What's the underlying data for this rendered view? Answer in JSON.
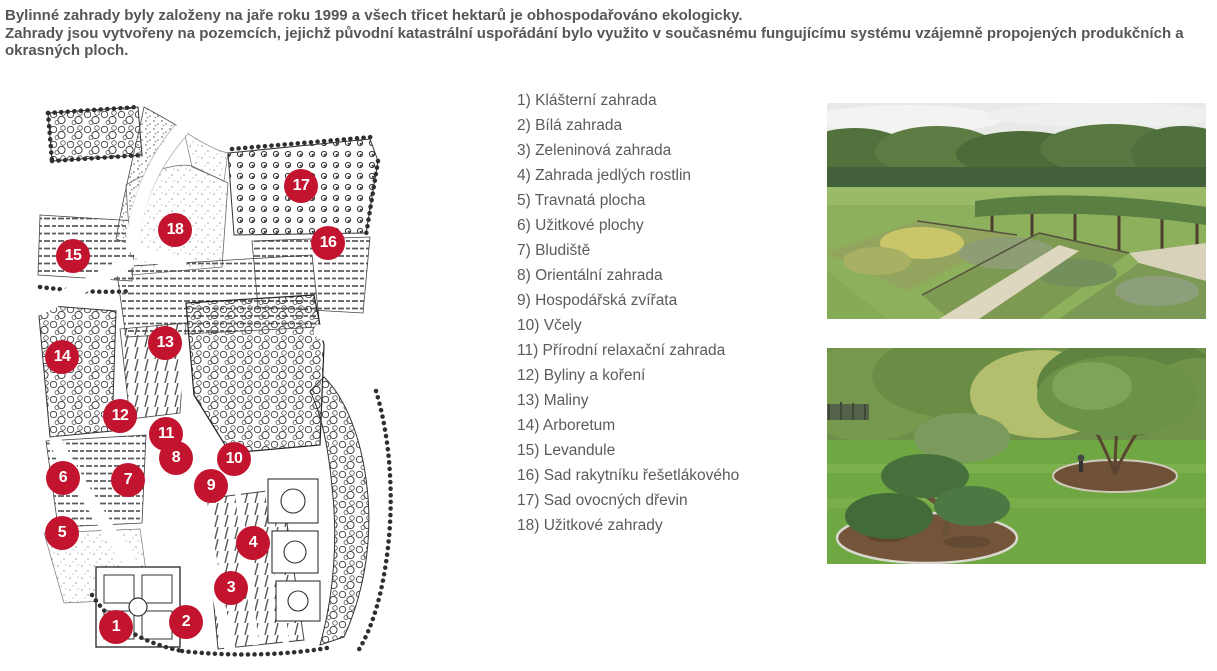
{
  "intro": {
    "p1": "Bylinné zahrady byly založeny na jaře roku 1999 a všech třicet hektarů je obhospodařováno ekologicky.",
    "p2": "Zahrady jsou vytvořeny na pozemcích, jejichž původní katastrální uspořádání bylo využito v současnému fungujícímu systému vzájemně propojených produkčních a okrasných ploch."
  },
  "legend": {
    "items": [
      "1) Klášterní zahrada",
      "2) Bílá zahrada",
      "3) Zeleninová zahrada",
      "4) Zahrada jedlých rostlin",
      "5) Travnatá plocha",
      "6) Užitkové plochy",
      "7) Bludiště",
      "8) Orientální zahrada",
      "9) Hospodářská zvířata",
      "10) Včely",
      "11) Přírodní relaxační zahrada",
      "12) Byliny a koření",
      "13) Maliny",
      "14) Arboretum",
      "15) Levandule",
      "16) Sad rakytníku řešetlákového",
      "17) Sad ovocných dřevin",
      "18) Užitkové zahrady"
    ]
  },
  "map": {
    "description": "hand-drawn garden site plan with numbered red markers",
    "marker_color": "#c2142f",
    "markers": [
      {
        "n": "1",
        "x": 116,
        "y": 627
      },
      {
        "n": "2",
        "x": 186,
        "y": 622
      },
      {
        "n": "3",
        "x": 231,
        "y": 588
      },
      {
        "n": "4",
        "x": 253,
        "y": 543
      },
      {
        "n": "5",
        "x": 62,
        "y": 533
      },
      {
        "n": "6",
        "x": 63,
        "y": 478
      },
      {
        "n": "7",
        "x": 128,
        "y": 480
      },
      {
        "n": "8",
        "x": 176,
        "y": 458
      },
      {
        "n": "9",
        "x": 211,
        "y": 486
      },
      {
        "n": "10",
        "x": 234,
        "y": 459
      },
      {
        "n": "11",
        "x": 166,
        "y": 434
      },
      {
        "n": "12",
        "x": 120,
        "y": 416
      },
      {
        "n": "13",
        "x": 165,
        "y": 343
      },
      {
        "n": "14",
        "x": 62,
        "y": 357
      },
      {
        "n": "15",
        "x": 73,
        "y": 256
      },
      {
        "n": "16",
        "x": 328,
        "y": 243
      },
      {
        "n": "17",
        "x": 301,
        "y": 186
      },
      {
        "n": "18",
        "x": 175,
        "y": 230
      }
    ]
  },
  "photos": [
    {
      "name": "herb-garden-raised-beds-photo"
    },
    {
      "name": "topiary-lawn-garden-photo"
    }
  ]
}
